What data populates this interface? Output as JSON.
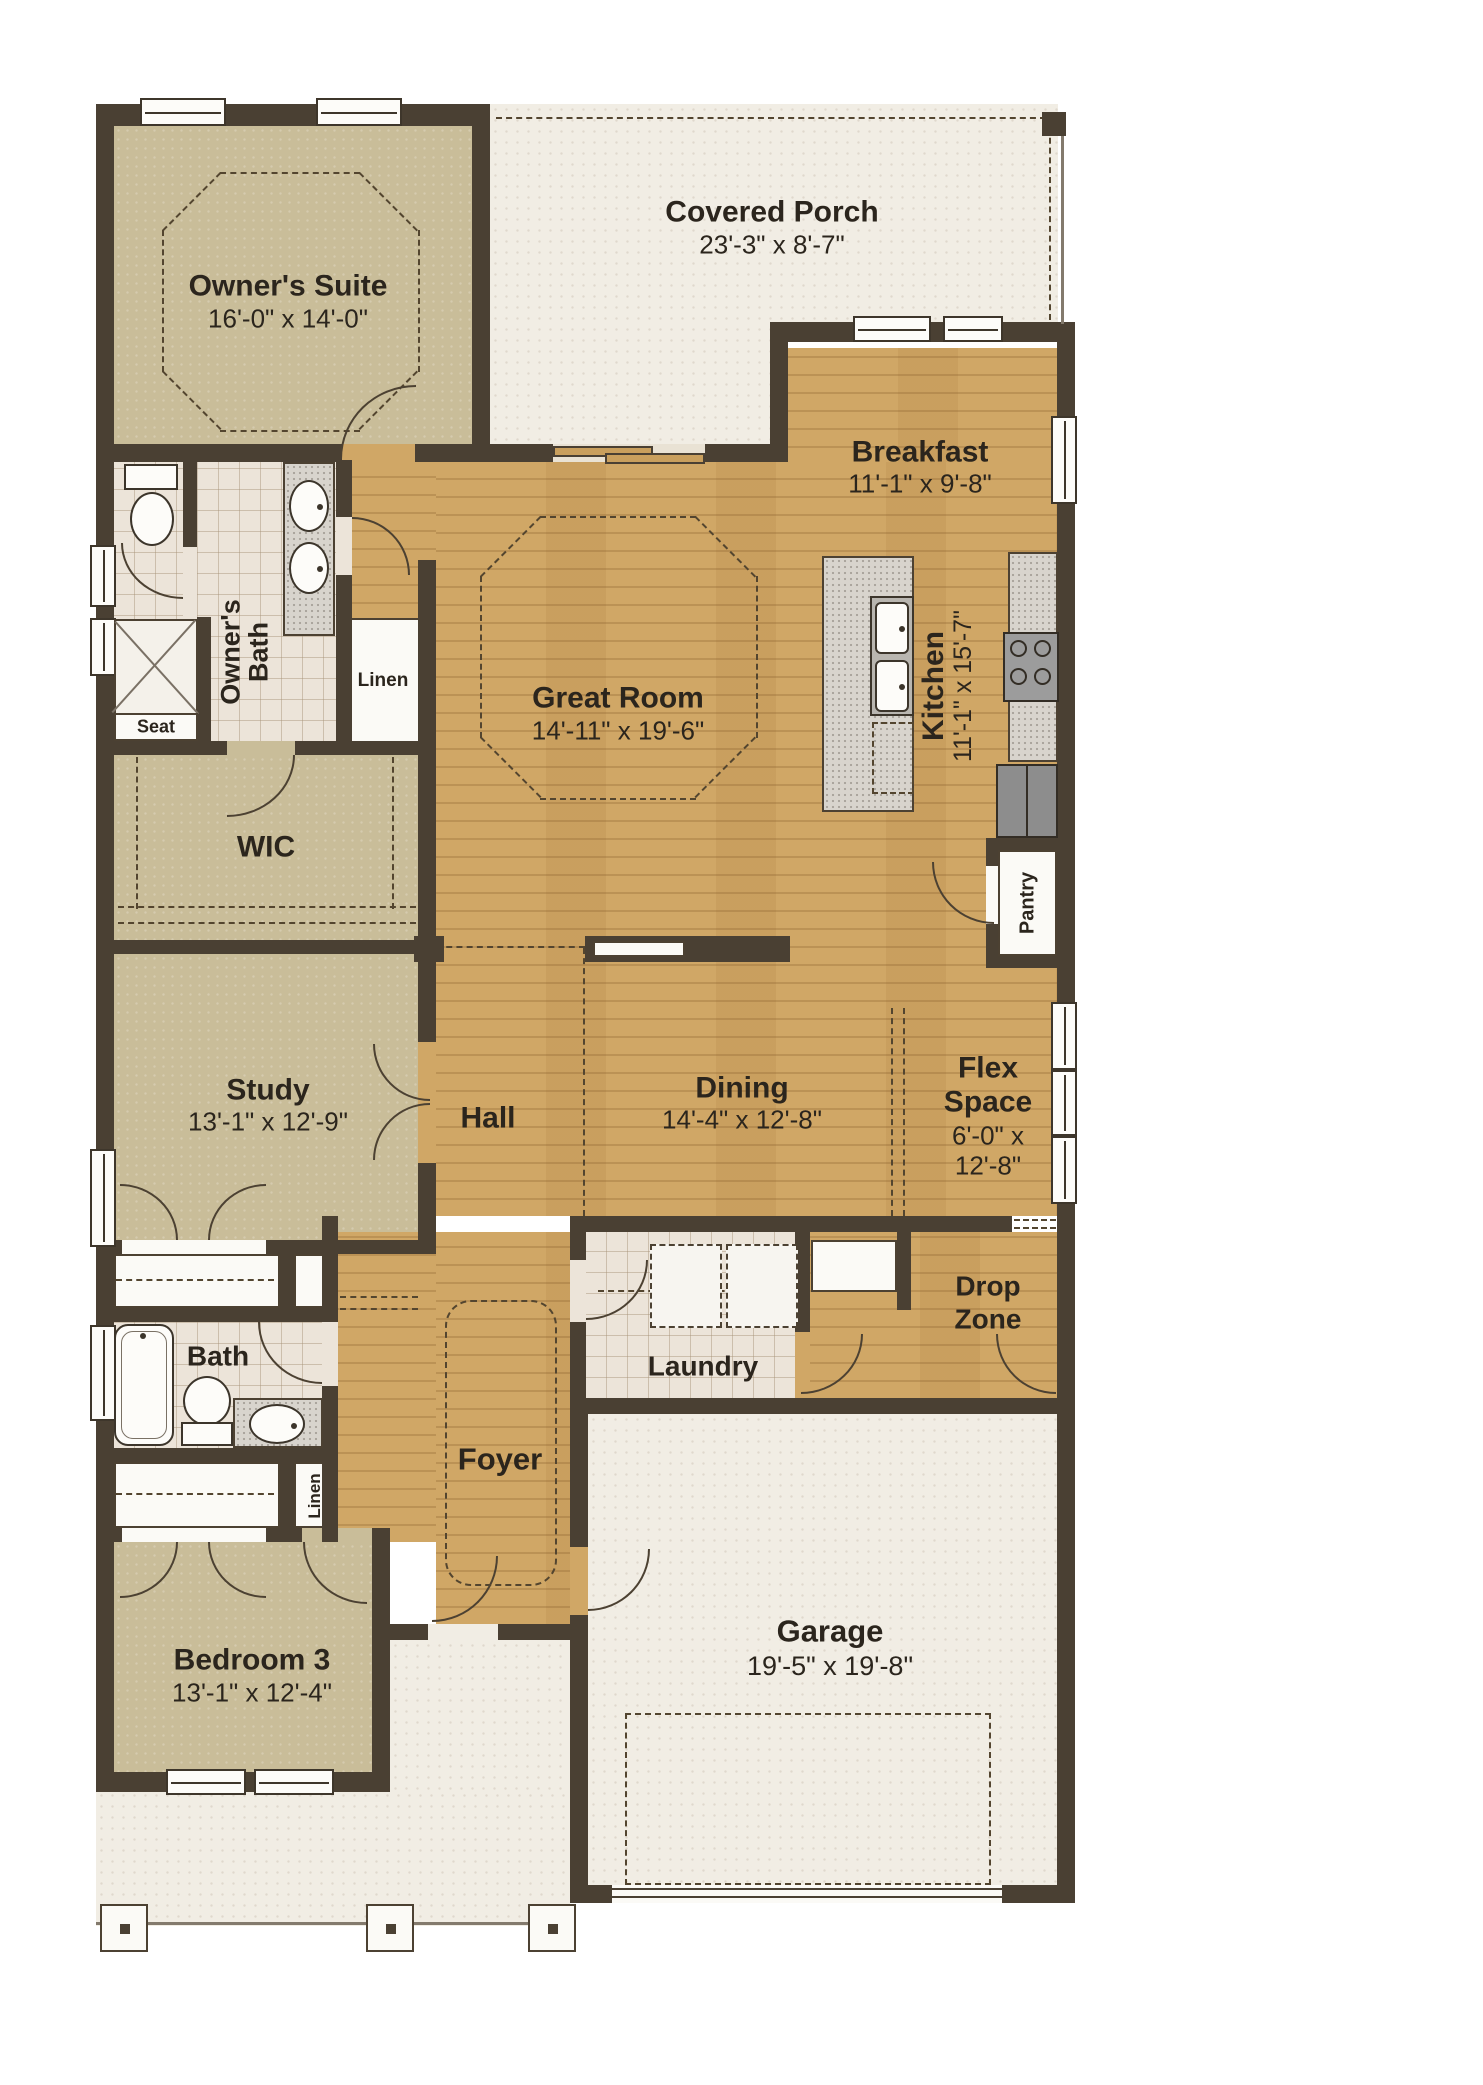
{
  "rooms": {
    "covered_porch": {
      "name": "Covered Porch",
      "dims": "23'-3\" x 8'-7\""
    },
    "owners_suite": {
      "name": "Owner's Suite",
      "dims": "16'-0\" x 14'-0\""
    },
    "breakfast": {
      "name": "Breakfast",
      "dims": "11'-1\" x 9'-8\""
    },
    "great_room": {
      "name": "Great Room",
      "dims": "14'-11\" x 19'-6\""
    },
    "kitchen": {
      "name": "Kitchen",
      "dims": "11'-1\" x 15'-7\""
    },
    "owners_bath": {
      "line1": "Owner's",
      "line2": "Bath"
    },
    "wic": {
      "name": "WIC"
    },
    "study": {
      "name": "Study",
      "dims": "13'-1\" x 12'-9\""
    },
    "hall": {
      "name": "Hall"
    },
    "dining": {
      "name": "Dining",
      "dims": "14'-4\" x 12'-8\""
    },
    "flex_space": {
      "name_line1": "Flex",
      "name_line2": "Space",
      "dims_line1": "6'-0\" x",
      "dims_line2": "12'-8\""
    },
    "drop_zone": {
      "name_line1": "Drop",
      "name_line2": "Zone"
    },
    "laundry": {
      "name": "Laundry"
    },
    "bath": {
      "name": "Bath"
    },
    "foyer": {
      "name": "Foyer"
    },
    "bedroom3": {
      "name": "Bedroom 3",
      "dims": "13'-1\" x 12'-4\""
    },
    "garage": {
      "name": "Garage",
      "dims": "19'-5\" x 19'-8\""
    }
  },
  "features": {
    "seat": "Seat",
    "linen_bath": "Linen",
    "linen_hall": "Linen",
    "pantry": "Pantry"
  },
  "colors": {
    "wall": "#4a4033",
    "wood_floor": "#d0a766",
    "carpet_floor": "#c9bd99",
    "tile_floor": "#ece4d9",
    "porch_floor": "#f1ede4",
    "text": "#2b251d"
  }
}
